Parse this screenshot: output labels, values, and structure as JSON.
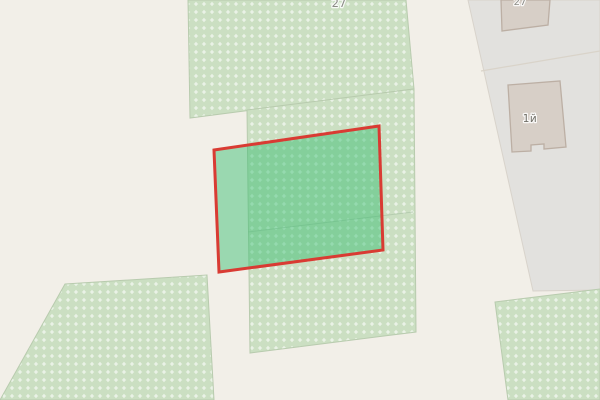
{
  "map": {
    "labels": {
      "vegetation_parcel_number": "27",
      "building_top_number": "27",
      "building_main_number": "1й"
    },
    "colors": {
      "background": "#f2efe8",
      "vegetation_fill": "#cbdfc2",
      "vegetation_dot": "#ffffff",
      "vegetation_border": "#b8cbae",
      "residential_zone_fill": "#e2e1de",
      "building_fill": "#d7cfc7",
      "building_border": "#bcafa4",
      "selected_parcel_fill": "rgba(47,189,108,0.45)",
      "selected_parcel_outline": "#d93b33",
      "parcel_label_color": "#8b8b86",
      "building_label_color": "#716f67"
    }
  }
}
